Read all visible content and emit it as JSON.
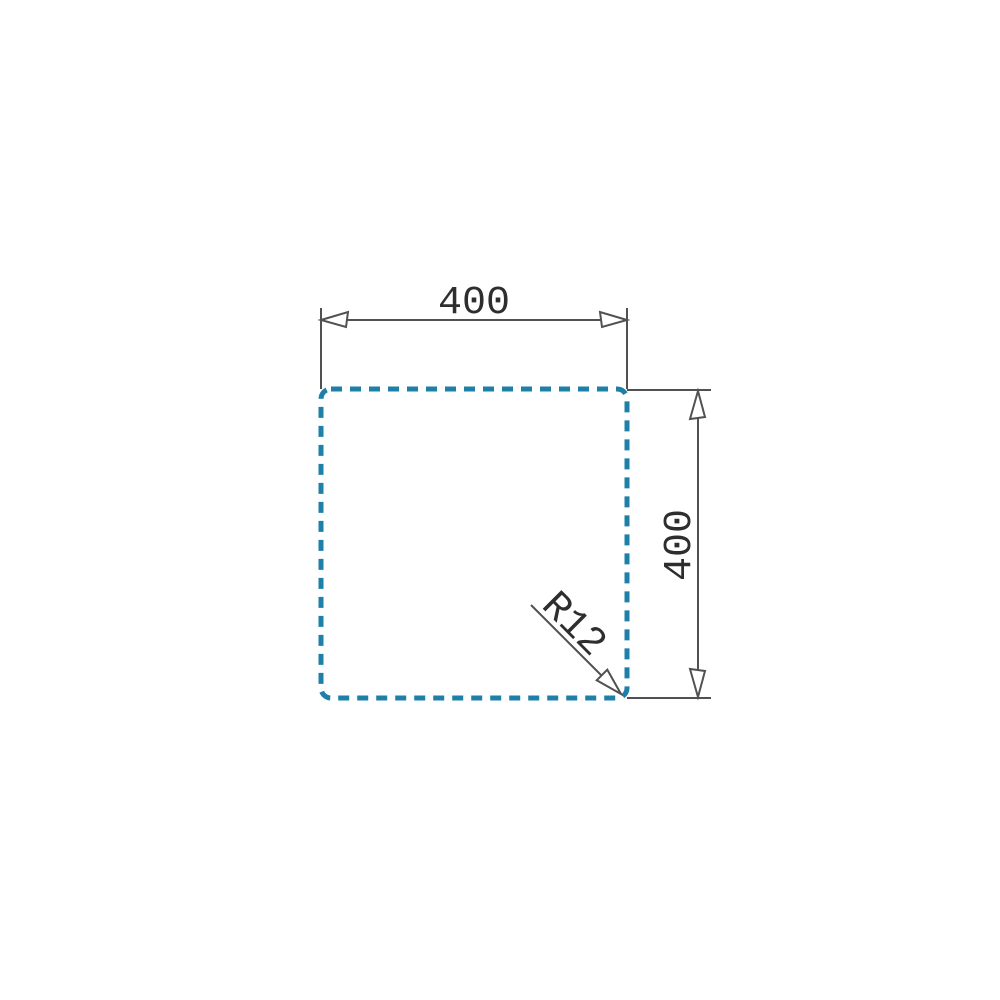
{
  "drawing": {
    "dimensions": {
      "width": {
        "label": "400"
      },
      "height": {
        "label": "400"
      },
      "corner_radius": {
        "label": "R12"
      }
    },
    "colors": {
      "cutout_outline": "#1e80a8",
      "dimension_lines": "#4f5153",
      "dimension_text": "#2e2e2e",
      "background": "#ffffff"
    }
  }
}
